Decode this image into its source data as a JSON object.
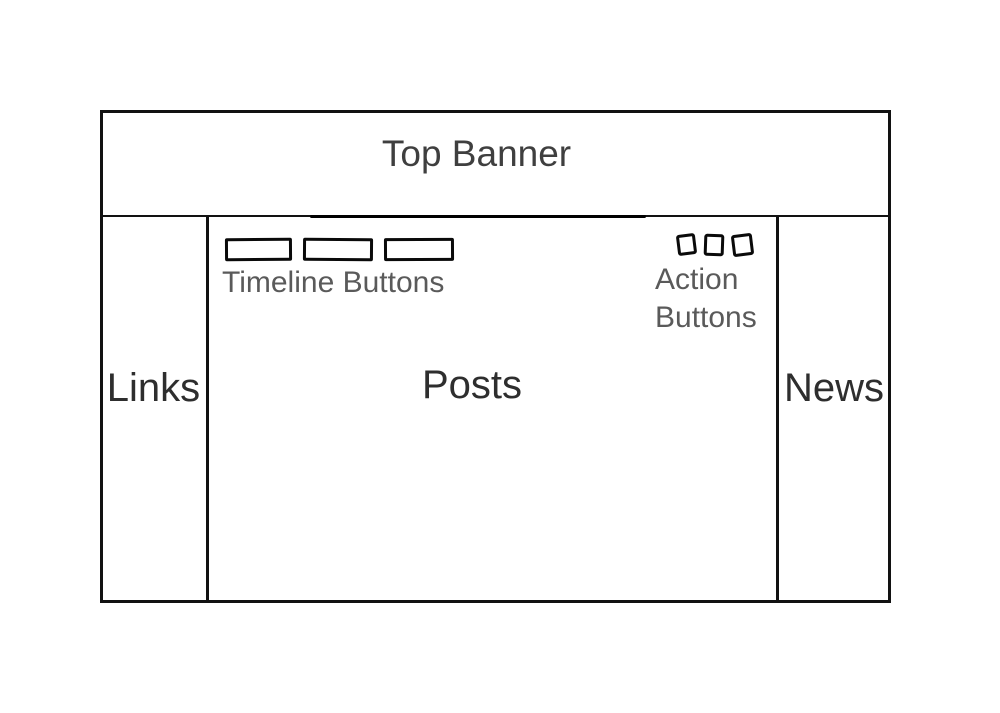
{
  "colors": {
    "stroke": "#121212",
    "heading_text": "#3f3f3f",
    "section_text": "#2e2e2e",
    "caption_text": "#5a5a5a",
    "background": "#ffffff"
  },
  "wireframe": {
    "banner": {
      "label": "Top Banner"
    },
    "left_sidebar": {
      "label": "Links"
    },
    "main": {
      "label": "Posts",
      "timeline": {
        "label": "Timeline Buttons",
        "button_count": 3
      },
      "actions": {
        "label": "Action Buttons",
        "button_count": 3
      }
    },
    "right_sidebar": {
      "label": "News"
    }
  }
}
